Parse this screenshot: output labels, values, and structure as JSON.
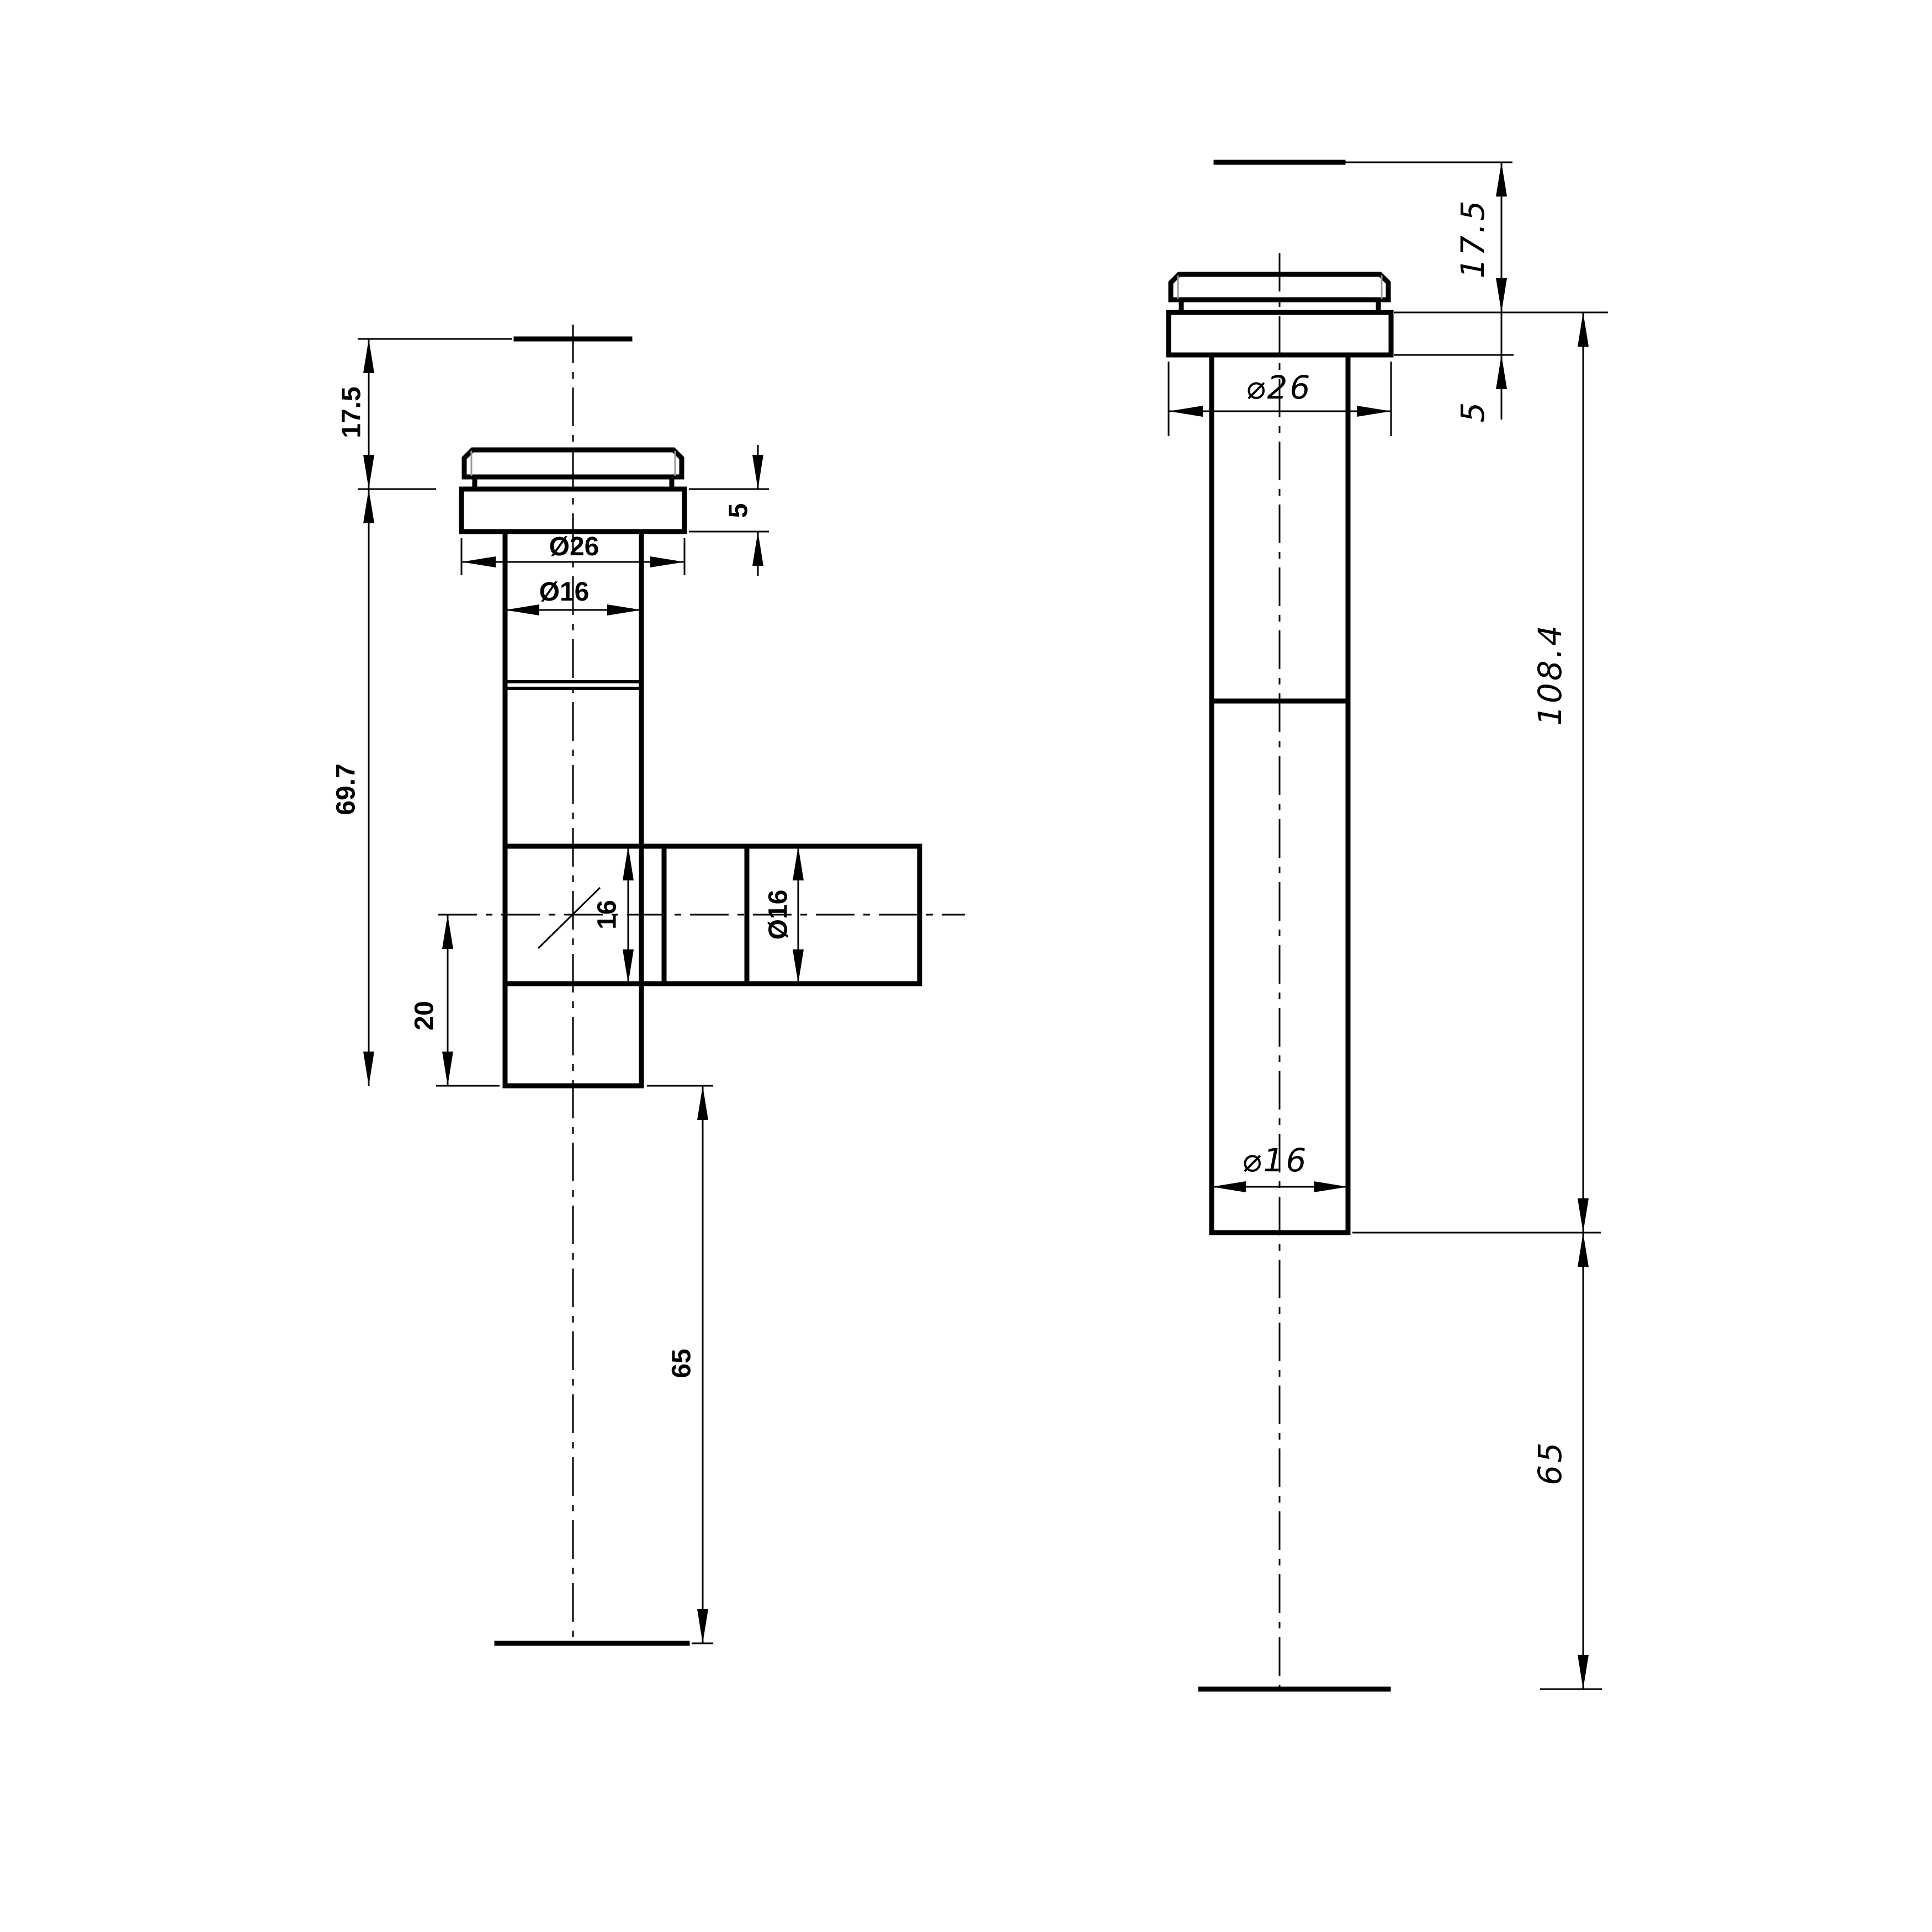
{
  "drawing": {
    "type": "technical-drawing",
    "background_color": "#ffffff",
    "line_color": "#000000",
    "chamfer_highlight_color": "#9a9a9a",
    "views_count": 2
  },
  "front_view": {
    "description": "T-fitting front view with cap, flange, vertical pipe and side branch",
    "dims": {
      "cap_height": "17.5",
      "body_length": "69.7",
      "flange_thickness": "5",
      "flange_diameter": "Ø26",
      "pipe_diameter": "Ø16",
      "branch_bore": "16",
      "branch_diameter": "Ø16",
      "branch_offset": "20",
      "tail_length": "65"
    }
  },
  "side_view": {
    "description": "Side view of same fitting, branch pointing away",
    "dims": {
      "cap_height": "17.5",
      "flange_thickness": "5",
      "flange_diameter": "⌀26",
      "overall_length": "108.4",
      "pipe_diameter": "⌀16",
      "tail_length": "65"
    }
  }
}
